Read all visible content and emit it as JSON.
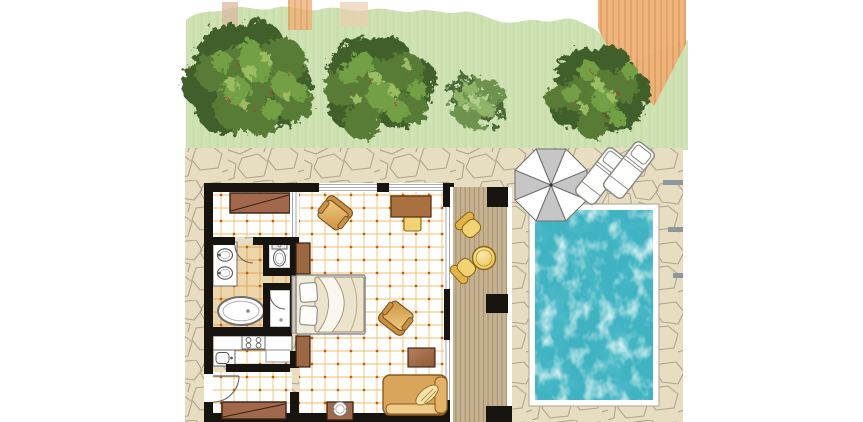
{
  "canvas": {
    "width": 863,
    "height": 422
  },
  "scene": {
    "description": "Top-down illustrated floor plan of a resort bungalow with lawn, trees, stone terrace, wooden deck, parasol, sun loungers and a private swimming pool",
    "rooms": [
      "bedroom-living area",
      "bathroom",
      "kitchenette",
      "entry hall",
      "dressing nook"
    ],
    "bathroom_fixtures": [
      "double washbasin vanity",
      "toilet",
      "shower",
      "oval bathtub"
    ],
    "kitchen_fixtures": [
      "counter",
      "four-burner stove",
      "sink unit",
      "cabinet"
    ],
    "bedroom_furniture": [
      "double bed",
      "nightstand",
      "nightstand",
      "wardrobe",
      "wardrobe",
      "armchair",
      "armchair",
      "desk",
      "stool",
      "side table",
      "sofa",
      "ice-bucket stand"
    ],
    "outdoor_features": [
      "lawn",
      "tree",
      "tree",
      "shrub",
      "tree",
      "stone terrace",
      "terrace steps",
      "wooden deck",
      "round table",
      "deck chair",
      "deck chair",
      "parasol",
      "sun lounger",
      "sun lounger",
      "swimming pool"
    ]
  },
  "colors": {
    "background": "#ffffff",
    "grass": "#cfe2b4",
    "grassStripe": "#c5daa6",
    "roofOrange": "#efb077",
    "roofStripe": "#dd9858",
    "stone": "#e7ddc1",
    "stoneLine": "#a89e86",
    "step": "#8f9898",
    "wall": "#17130e",
    "tileLine": "#f0b356",
    "tileDot": "#c05f14",
    "bathTile": "#eed6ab",
    "bathTileLine": "#dda14a",
    "bathTileDot": "#b96018",
    "fixtureWhite": "#ffffff",
    "fixtureOutline": "#6f6f6f",
    "wood": "#c6b291",
    "woodLine": "#9f8c6b",
    "gold": "#f2d272",
    "goldDeep": "#e3b34a",
    "goldStroke": "#8a6510",
    "brown": "#a2684b",
    "brownStroke": "#35200f",
    "deskBrown": "#a8713f",
    "nightstand": "#9c6844",
    "armLight": "#f0cd84",
    "armDeep": "#cd9040",
    "armStroke": "#7b5623",
    "sofa": "#d9a55b",
    "sofaLight": "#eecb88",
    "sofaStroke": "#8a5a1e",
    "linen": "#ece3cc",
    "linenLine": "#96896c",
    "pillow": "#fdfdf9",
    "bedFrame": "#8f8f8f",
    "poolRim": "#ffffff",
    "poolRimEdge": "#b6af9f",
    "water": "#3fb3c2",
    "waterLight": "#d9f4ec",
    "waterDeep": "#1f8fa4",
    "umbrellaWhite": "#ffffff",
    "umbrellaGray": "#c6c6c6",
    "umbrellaStroke": "#6e6e6e",
    "loungerWhite": "#ffffff",
    "loungerStroke": "#8a8a84",
    "treeDark": "#3f5e2b",
    "treeMid": "#587c35",
    "treeLight": "#73a044",
    "treeGlow": "#9abd62",
    "treeBerry": "#a04a36",
    "bushDark": "#4c6b37",
    "bushMid": "#6d9350",
    "bushLight": "#8fb468",
    "bushGlow": "#b3cc8f",
    "windowLine": "#8b949b"
  }
}
